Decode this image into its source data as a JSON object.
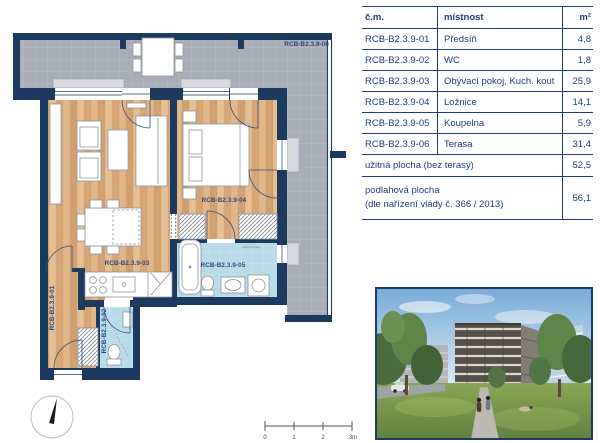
{
  "plan": {
    "terrace": "RCB-B2.3.9-06",
    "hall": "RCB-B2.3.9-01",
    "wc": "RCB-B2.3.9-02",
    "living": "RCB-B2.3.9-03",
    "bedroom": "RCB-B2.3.9-04",
    "bathroom": "RCB-B2.3.9-05",
    "scale": {
      "t0": "0",
      "t1": "1",
      "t2": "2",
      "t3": "3m"
    }
  },
  "table": {
    "header": {
      "code": "č.m.",
      "room": "místnost",
      "area": "m²"
    },
    "rows": [
      {
        "code": "RCB-B2.3.9-01",
        "room": "Předsíň",
        "area": "4,8"
      },
      {
        "code": "RCB-B2.3.9-02",
        "room": "WC",
        "area": "1,8"
      },
      {
        "code": "RCB-B2.3.9-03",
        "room": "Obývací pokoj, Kuch. kout",
        "area": "25,9"
      },
      {
        "code": "RCB-B2.3.9-04",
        "room": "Ložnice",
        "area": "14,1"
      },
      {
        "code": "RCB-B2.3.9-05",
        "room": "Koupelna",
        "area": "5,9"
      },
      {
        "code": "RCB-B2.3.9-06",
        "room": "Terasa",
        "area": "31,4"
      }
    ],
    "usable": {
      "label": "užitná plocha (bez terasy)",
      "area": "52,5"
    },
    "floor": {
      "label1": "podlahová plocha",
      "label2": "(dle nařízení vlády č. 366 / 2013)",
      "area": "56,1"
    }
  },
  "colors": {
    "wall_navy": "#1c3a60",
    "label_navy": "#2a4780",
    "terrace_gray": "#a9adb8",
    "wood": "#ddb083",
    "wet_room_blue": "#b7dbe9"
  }
}
